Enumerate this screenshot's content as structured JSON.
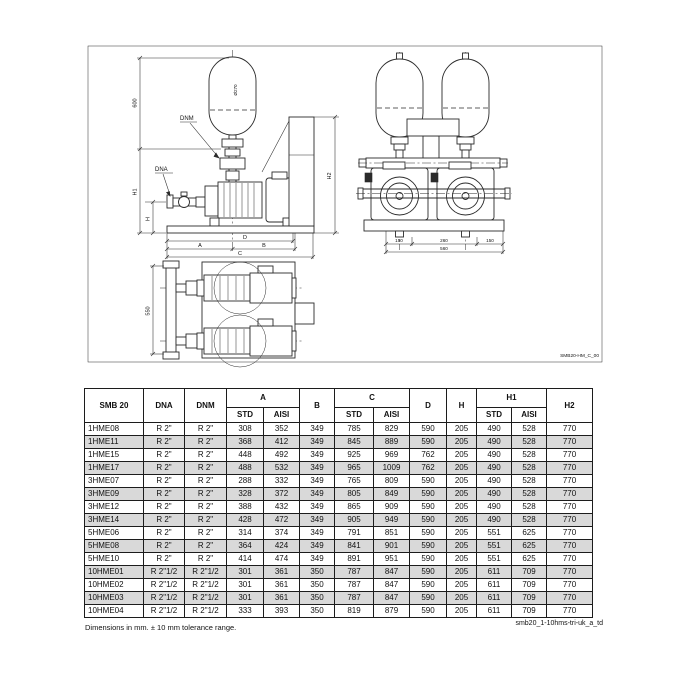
{
  "drawing": {
    "line_color": "#2b2b2b",
    "frame_ref": "SMB20-HM_C_00",
    "labels": {
      "tank_height": "600",
      "tank_diameter": "Ø270",
      "dnm": "DNM",
      "dna": "DNA",
      "h1": "H1",
      "h": "H",
      "h2": "H2",
      "dim_d": "D",
      "dim_a": "A",
      "dim_b": "B",
      "dim_c": "C",
      "front_seg_left": "150",
      "front_seg_mid": "260",
      "front_seg_right": "150",
      "front_total": "560",
      "plan_depth": "550"
    }
  },
  "table": {
    "header": {
      "model": "SMB 20",
      "dna": "DNA",
      "dnm": "DNM",
      "a": "A",
      "b": "B",
      "c": "C",
      "d": "D",
      "h": "H",
      "h1": "H1",
      "h2": "H2",
      "std": "STD",
      "aisi": "AISI"
    },
    "rows": [
      [
        "1HME08",
        "R 2\"",
        "R 2\"",
        "308",
        "352",
        "349",
        "785",
        "829",
        "590",
        "205",
        "490",
        "528",
        "770"
      ],
      [
        "1HME11",
        "R 2\"",
        "R 2\"",
        "368",
        "412",
        "349",
        "845",
        "889",
        "590",
        "205",
        "490",
        "528",
        "770"
      ],
      [
        "1HME15",
        "R 2\"",
        "R 2\"",
        "448",
        "492",
        "349",
        "925",
        "969",
        "762",
        "205",
        "490",
        "528",
        "770"
      ],
      [
        "1HME17",
        "R 2\"",
        "R 2\"",
        "488",
        "532",
        "349",
        "965",
        "1009",
        "762",
        "205",
        "490",
        "528",
        "770"
      ],
      [
        "3HME07",
        "R 2\"",
        "R 2\"",
        "288",
        "332",
        "349",
        "765",
        "809",
        "590",
        "205",
        "490",
        "528",
        "770"
      ],
      [
        "3HME09",
        "R 2\"",
        "R 2\"",
        "328",
        "372",
        "349",
        "805",
        "849",
        "590",
        "205",
        "490",
        "528",
        "770"
      ],
      [
        "3HME12",
        "R 2\"",
        "R 2\"",
        "388",
        "432",
        "349",
        "865",
        "909",
        "590",
        "205",
        "490",
        "528",
        "770"
      ],
      [
        "3HME14",
        "R 2\"",
        "R 2\"",
        "428",
        "472",
        "349",
        "905",
        "949",
        "590",
        "205",
        "490",
        "528",
        "770"
      ],
      [
        "5HME06",
        "R 2\"",
        "R 2\"",
        "314",
        "374",
        "349",
        "791",
        "851",
        "590",
        "205",
        "551",
        "625",
        "770"
      ],
      [
        "5HME08",
        "R 2\"",
        "R 2\"",
        "364",
        "424",
        "349",
        "841",
        "901",
        "590",
        "205",
        "551",
        "625",
        "770"
      ],
      [
        "5HME10",
        "R 2\"",
        "R 2\"",
        "414",
        "474",
        "349",
        "891",
        "951",
        "590",
        "205",
        "551",
        "625",
        "770"
      ],
      [
        "10HME01",
        "R 2\"1/2",
        "R 2\"1/2",
        "301",
        "361",
        "350",
        "787",
        "847",
        "590",
        "205",
        "611",
        "709",
        "770"
      ],
      [
        "10HME02",
        "R 2\"1/2",
        "R 2\"1/2",
        "301",
        "361",
        "350",
        "787",
        "847",
        "590",
        "205",
        "611",
        "709",
        "770"
      ],
      [
        "10HME03",
        "R 2\"1/2",
        "R 2\"1/2",
        "301",
        "361",
        "350",
        "787",
        "847",
        "590",
        "205",
        "611",
        "709",
        "770"
      ],
      [
        "10HME04",
        "R 2\"1/2",
        "R 2\"1/2",
        "333",
        "393",
        "350",
        "819",
        "879",
        "590",
        "205",
        "611",
        "709",
        "770"
      ]
    ]
  },
  "footer": {
    "note": "Dimensions in mm. ± 10 mm tolerance range.",
    "doc_ref": "smb20_1-10hms-tri-uk_a_td"
  }
}
